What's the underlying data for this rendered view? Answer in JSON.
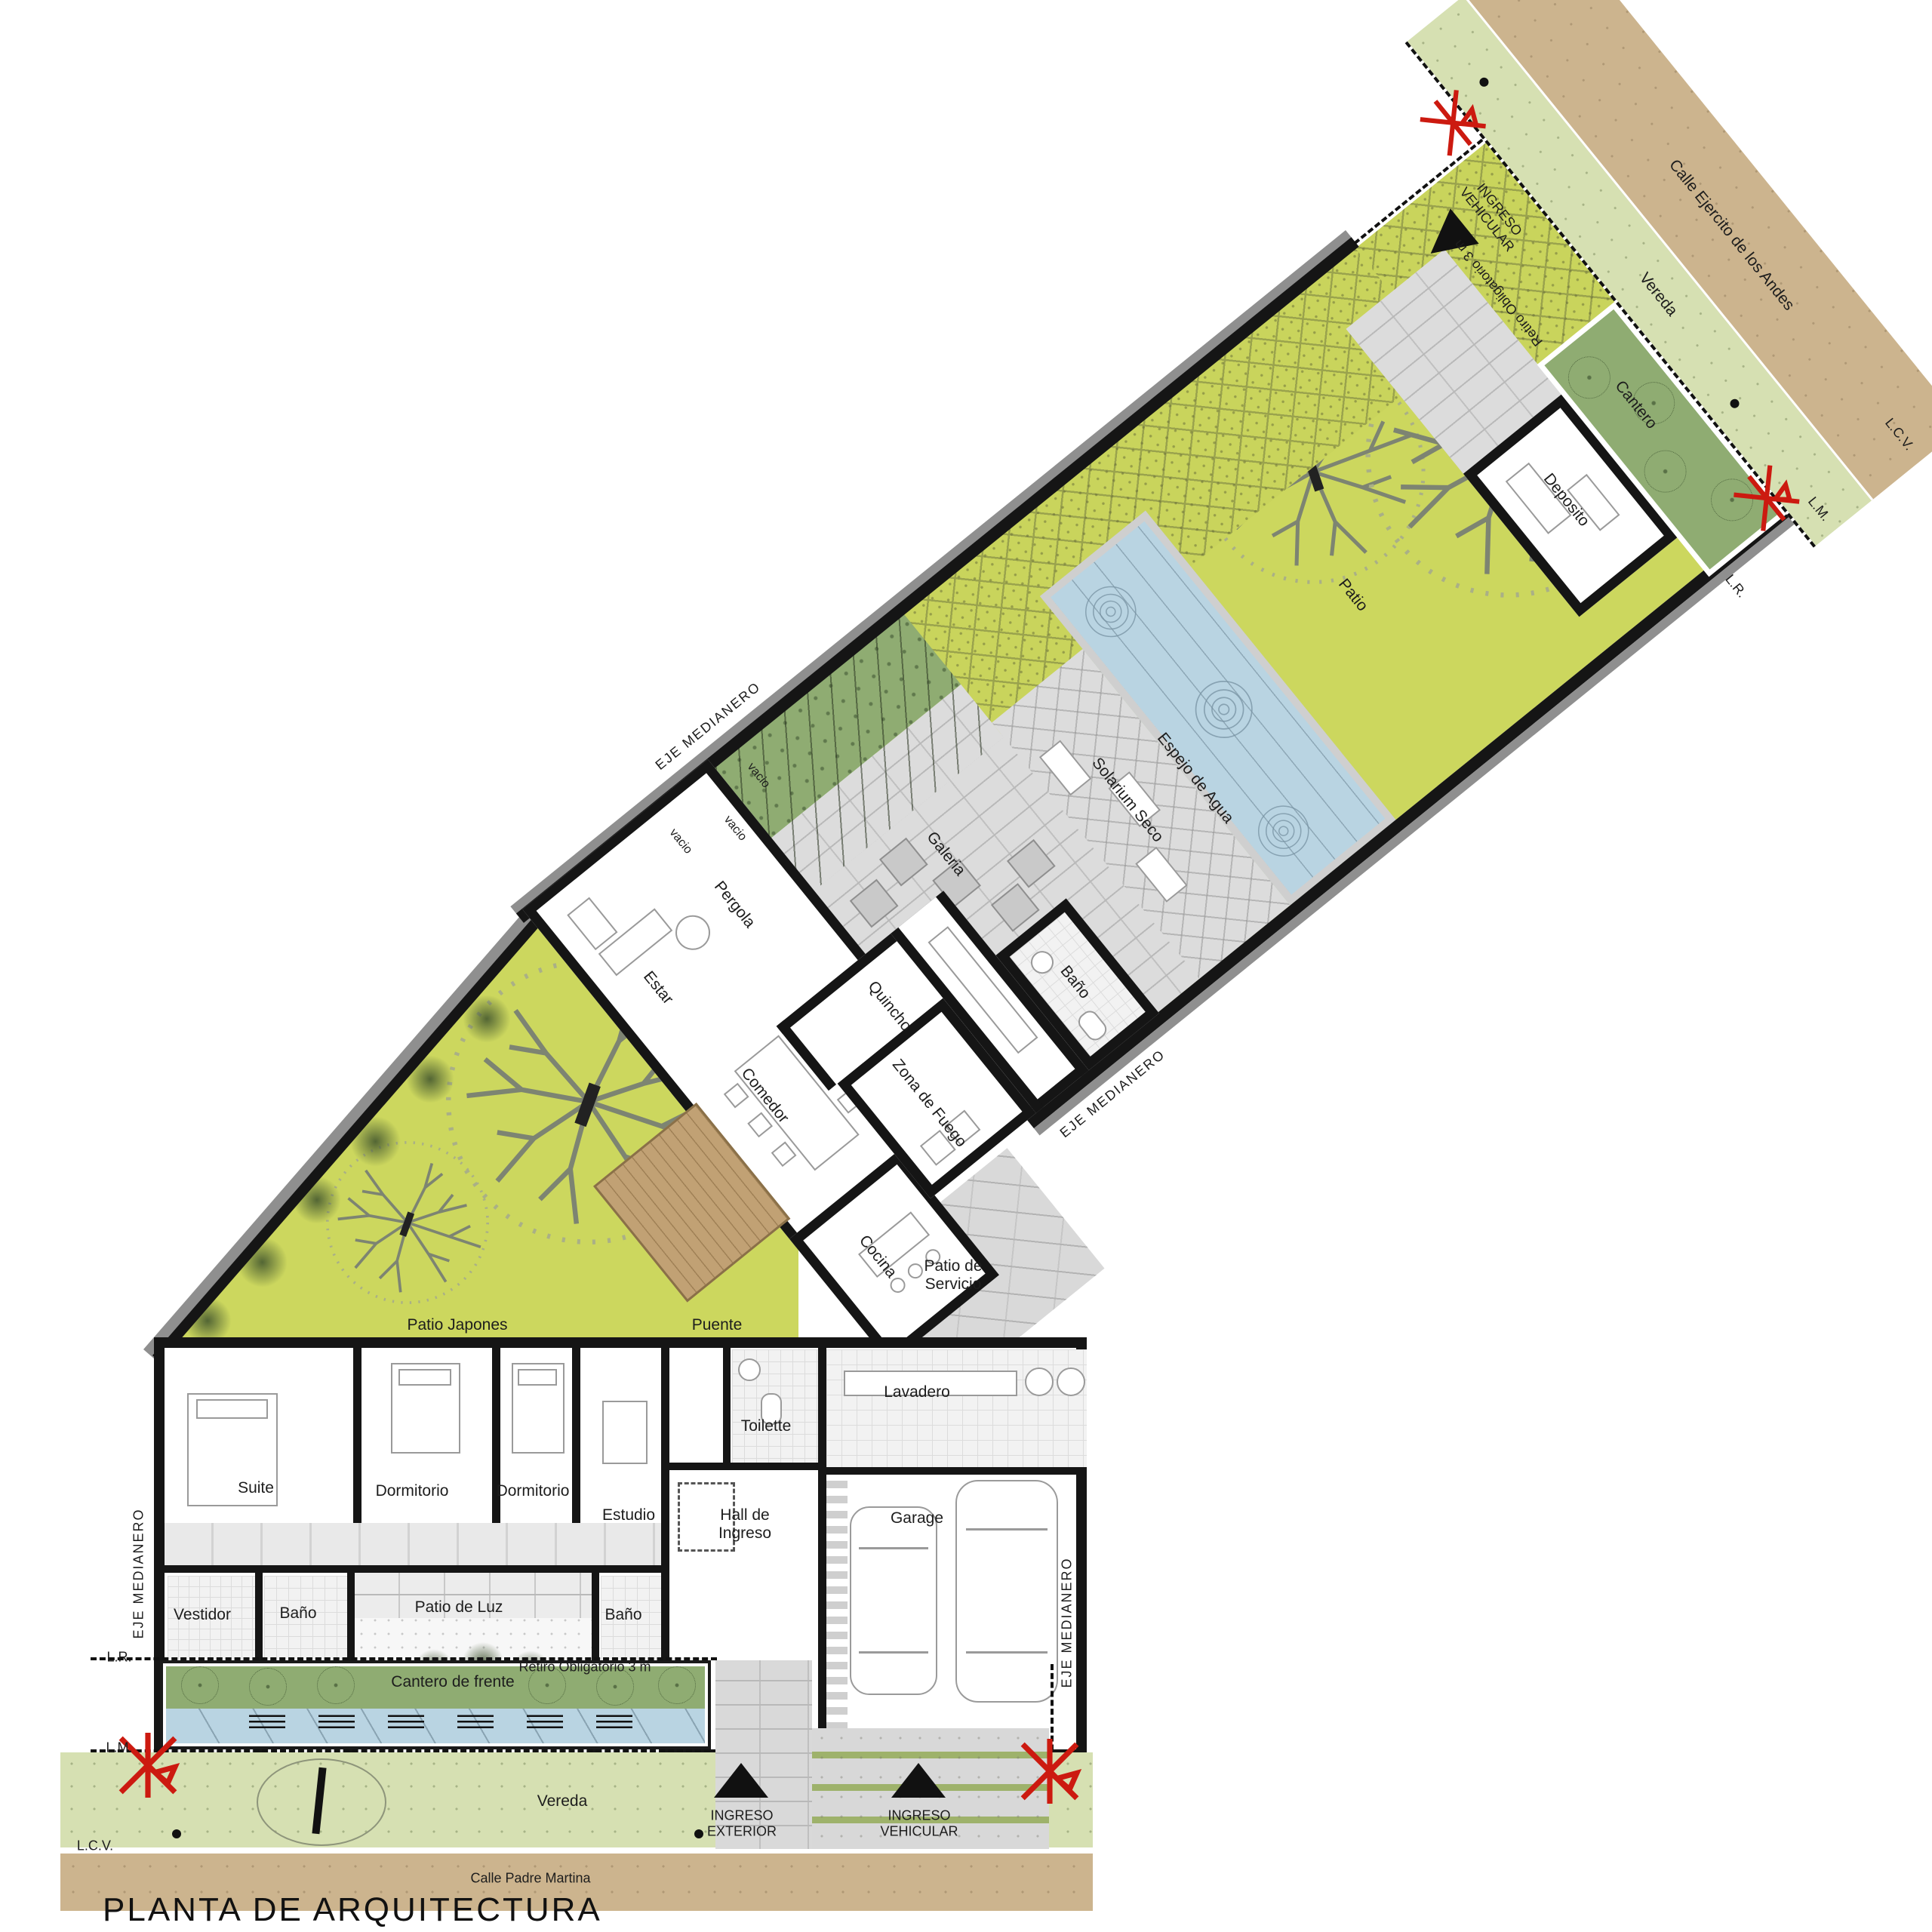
{
  "plan": {
    "title": "PLANTA DE ARQUITECTURA",
    "rooms": {
      "suite": "Suite",
      "dormitorio": "Dormitorio",
      "estudio": "Estudio",
      "vestidor": "Vestidor",
      "bano": "Baño",
      "patio_de_luz": "Patio de Luz",
      "hall_l1": "Hall de",
      "hall_l2": "Ingreso",
      "toilette": "Toilette",
      "lavadero": "Lavadero",
      "garage": "Garage",
      "estar": "Estar",
      "comedor": "Comedor",
      "cocina": "Cocina",
      "zona_de_fuego": "Zona de Fuego",
      "patio_servicio_l1": "Patio de",
      "patio_servicio_l2": "Servicio",
      "quincho": "Quincho",
      "galeria": "Galeria",
      "pergola": "Pergola",
      "vacio": "vacio",
      "solarium_seco": "Solarium Seco",
      "espejo_de_agua": "Espejo de Agua",
      "patio": "Patio",
      "deposito": "Deposito",
      "patio_japones": "Patio Japones",
      "puente": "Puente"
    },
    "site": {
      "cantero": "Cantero",
      "cantero_de_frente": "Cantero de frente",
      "retiro": "Retiro Obligatorio 3 m",
      "vereda": "Vereda",
      "calle_sur": "Calle Padre Martina",
      "calle_norte": "Calle Ejercito de los Andes",
      "eje_medianero": "EJE MEDIANERO",
      "lr": "L.R.",
      "lm": "L.M.",
      "lcv": "L.C.V.",
      "ingreso_exterior_l1": "INGRESO",
      "ingreso_exterior_l2": "EXTERIOR",
      "ingreso_vehicular_l1": "INGRESO",
      "ingreso_vehicular_l2": "VEHICULAR"
    },
    "colors": {
      "lawn": "#ccd75e",
      "planter_green": "#8fac72",
      "sidewalk_green": "#d6e0b2",
      "street_tan": "#ccb48e",
      "water_blue": "#b9d4e2",
      "paving_grey": "#dcdcdc",
      "wall_black": "#151515",
      "survey_red": "#cc1a10",
      "bridge_wood": "#c1a174"
    }
  }
}
